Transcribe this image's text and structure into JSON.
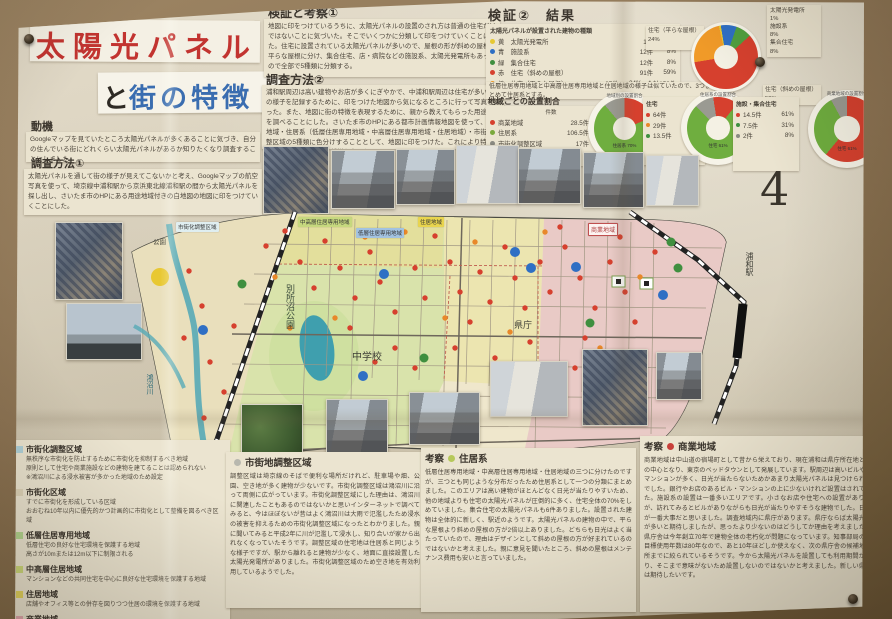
{
  "page_number": "4",
  "title": {
    "main": "太陽光パネル",
    "sub_prefix": "と",
    "sub_main": "街の特徴"
  },
  "intro": {
    "motivation_heading": "動機",
    "motivation_body": "Googleマップを見ていたところ太陽光パネルが多くあることに気づき、自分の住んでいる街にどれくらい太陽光パネルがあるか知りたくなり調査することにしました。",
    "method1_heading": "調査方法①",
    "method1_body": "太陽光パネルを通して街の様子が見えてこないかと考え、Googleマップの航空写真を使って、埼京線中浦和駅から京浜東北線浦和駅の間から太陽光パネルを探し出し、さいたま市のHPにある用途地域付きの白地図の地図に印をつけていくことにした。"
  },
  "upper": {
    "verification1_heading": "検証と考察①",
    "verification1_body": "地図に印をつけているうちに、太陽光パネルの設置のされ方は普通の住宅だけではないことに気づいた。そこでいくつかに分類して印をつけていくことにした。住宅に設置されている太陽光パネルが多いので、屋根の形が斜めの屋根と平らな屋根に分け、集合住宅、店・病院などの施設系、太陽光発電所もあったので全部で5種類に分類する。",
    "method2_heading": "調査方法②",
    "method2_body": "浦和駅周辺は高い建物やお店が多くにぎやかで、中浦和駅周辺は住宅が多い。街の様子を記録するために、印をつけた地図から気になるところに行って写真を撮った。また、地図に街の特徴を表現するために、親から教えてもらった用途地域を調べることにした。さいたま市のHPにある都市計画情報地図を使って、商業地域・住居系（低層住居専用地域・中高層住居専用地域・住居地域）・市街化調整区域の5種類に色分けすることとして、地図に印をつけた。これにより特徴が浮かびあがってくると仮説を立てた。"
  },
  "results": {
    "heading": "検証②　結果",
    "table_title": "太陽光パネルが設置された建物の種類",
    "rows": [
      {
        "color": "#e6c832",
        "label": "黄　太陽光発電所",
        "count": "1件",
        "pct": "1%"
      },
      {
        "color": "#2f6fc4",
        "label": "青　施設系",
        "count": "12件",
        "pct": "8%"
      },
      {
        "color": "#3f8f3f",
        "label": "緑　集合住宅",
        "count": "12件",
        "pct": "8%"
      },
      {
        "color": "#d6402e",
        "label": "赤　住宅（斜めの屋根）",
        "count": "91件",
        "pct": "59%"
      },
      {
        "color": "#f09a28",
        "label": "橙　住宅（平らな屋根）",
        "count": "37件",
        "pct": "24%"
      }
    ],
    "total": "合計153件",
    "note": "低層住居専用地域と中高層住居専用地域と住居地域の様子は似ていたので、3つまとめて住居系とする。"
  },
  "region_share": {
    "heading": "地域ごとの設置割合",
    "col_header": "件数",
    "rows": [
      {
        "color": "#d6402e",
        "label": "商業地域",
        "count": "28.5件",
        "pct": "19%"
      },
      {
        "color": "#7aa93c",
        "label": "住居系",
        "count": "106.5件",
        "pct": "70%"
      },
      {
        "color": "#8a8a82",
        "label": "市街化調整区域",
        "count": "17件",
        "pct": "11%"
      }
    ],
    "footnote": "※都市公園　1件"
  },
  "sub_stats": [
    {
      "header": "住宅",
      "rows": [
        {
          "color": "#d6402e",
          "count": "64件",
          "pct": "61%"
        },
        {
          "color": "#e8882a",
          "count": "29件",
          "pct": "27%"
        },
        {
          "color": "#3f8f3f",
          "count": "13.5件",
          "pct": "12%"
        }
      ]
    },
    {
      "header": "施設・集合住宅",
      "rows": [
        {
          "color": "#d6402e",
          "count": "14.5件",
          "pct": "61%"
        },
        {
          "color": "#3f8f3f",
          "count": "7.5件",
          "pct": "31%"
        },
        {
          "color": "#8a8a82",
          "count": "2件",
          "pct": "8%"
        }
      ]
    }
  ],
  "big_donut": {
    "slices": [
      {
        "color": "#e6c832",
        "pct": 1
      },
      {
        "color": "#2f6fc4",
        "pct": 8
      },
      {
        "color": "#4f9f3f",
        "pct": 8
      },
      {
        "color": "#d6402e",
        "pct": 59
      },
      {
        "color": "#f09a28",
        "pct": 24
      }
    ],
    "legend_right": "太陽光発電所\n1%\n施設系\n8%\n集合住宅\n8%",
    "label_left": "住宅（平らな屋根）\n24%",
    "label_bottom": "住宅（斜めの屋根）\n59%"
  },
  "donut1": {
    "header": "地域別の設置割合",
    "inner_label": "住居系 70%",
    "slices": [
      {
        "color": "#9a9a92",
        "pct": 11
      },
      {
        "color": "#d6402e",
        "pct": 19
      },
      {
        "color": "#6fae3f",
        "pct": 70
      }
    ]
  },
  "donut2": {
    "header": "住居系の設置割合",
    "inner_label": "住宅 61%",
    "slices": [
      {
        "color": "#9a9a92",
        "pct": 10
      },
      {
        "color": "#d6402e",
        "pct": 13
      },
      {
        "color": "#6fae3f",
        "pct": 77
      }
    ]
  },
  "donut3": {
    "header": "商業地域の設置割合",
    "inner_label": "住宅 61%",
    "slices": [
      {
        "color": "#d6402e",
        "pct": 61
      },
      {
        "color": "#6fae3f",
        "pct": 31
      },
      {
        "color": "#9a9a92",
        "pct": 8
      }
    ]
  },
  "map": {
    "tags": [
      {
        "label": "市街化調整区域",
        "bg": "#dfeef0"
      },
      {
        "label": "中高層住居専用地域",
        "bg": "#c6d87e"
      },
      {
        "label": "低層住居専用地域",
        "bg": "#a2c2e0"
      },
      {
        "label": "住居地域",
        "bg": "#e8d44e"
      },
      {
        "label": "商業地域",
        "bg": "#fdf4f2"
      }
    ],
    "places": [
      "別所沼公園",
      "中学校",
      "県庁",
      "浦和駅",
      "鴻沼川",
      "公園"
    ],
    "dots": [
      {
        "name": "住宅（斜めの屋根）",
        "color": "#d6402e",
        "r": 2.7,
        "points": [
          [
            75,
            65
          ],
          [
            88,
            100
          ],
          [
            70,
            132
          ],
          [
            96,
            156
          ],
          [
            110,
            186
          ],
          [
            90,
            212
          ],
          [
            120,
            120
          ],
          [
            152,
            40
          ],
          [
            171,
            25
          ],
          [
            186,
            56
          ],
          [
            200,
            82
          ],
          [
            211,
            35
          ],
          [
            226,
            62
          ],
          [
            241,
            92
          ],
          [
            236,
            122
          ],
          [
            256,
            46
          ],
          [
            266,
            76
          ],
          [
            281,
            106
          ],
          [
            301,
            62
          ],
          [
            311,
            92
          ],
          [
            321,
            30
          ],
          [
            336,
            56
          ],
          [
            346,
            86
          ],
          [
            356,
            116
          ],
          [
            341,
            142
          ],
          [
            366,
            66
          ],
          [
            376,
            96
          ],
          [
            391,
            41
          ],
          [
            401,
            72
          ],
          [
            411,
            102
          ],
          [
            426,
            56
          ],
          [
            436,
            86
          ],
          [
            301,
            162
          ],
          [
            281,
            142
          ],
          [
            261,
            156
          ],
          [
            381,
            152
          ],
          [
            416,
            136
          ],
          [
            451,
            41
          ],
          [
            466,
            72
          ],
          [
            481,
            102
          ],
          [
            471,
            132
          ],
          [
            496,
            56
          ],
          [
            511,
            86
          ],
          [
            521,
            116
          ],
          [
            541,
            46
          ],
          [
            531,
            152
          ],
          [
            461,
            162
          ],
          [
            506,
            31
          ],
          [
            446,
            21
          ],
          [
            426,
            206
          ]
        ]
      },
      {
        "name": "住宅（平らな屋根）",
        "color": "#e8882a",
        "r": 2.7,
        "points": [
          [
            161,
            71
          ],
          [
            221,
            112
          ],
          [
            251,
            31
          ],
          [
            331,
            112
          ],
          [
            361,
            36
          ],
          [
            396,
            126
          ],
          [
            431,
            26
          ],
          [
            486,
            142
          ],
          [
            526,
            71
          ],
          [
            291,
            26
          ],
          [
            176,
            122
          ],
          [
            406,
            162
          ]
        ]
      },
      {
        "name": "集合住宅",
        "color": "#3f8f3f",
        "r": 4.5,
        "points": [
          [
            128,
            78
          ],
          [
            310,
            152
          ],
          [
            476,
            117
          ],
          [
            557,
            36
          ],
          [
            564,
            62
          ]
        ]
      },
      {
        "name": "施設系",
        "color": "#2f6fc4",
        "r": 5,
        "points": [
          [
            270,
            68
          ],
          [
            89,
            124
          ],
          [
            401,
            46
          ],
          [
            417,
            62
          ],
          [
            462,
            61
          ],
          [
            549,
            89
          ],
          [
            249,
            170
          ]
        ]
      },
      {
        "name": "太陽光発電所",
        "color": "#e8c832",
        "r": 9,
        "points": [
          [
            46,
            71
          ]
        ]
      }
    ]
  },
  "legend": {
    "items": [
      {
        "chip": "#aed0d8",
        "heading": "市街化調整区域",
        "body": "無秩序な市街化を防止するために市街化を抑制するべき地域\n原則として住宅や商業施設などの建物を建てることは認められない\n※鴻沼川による浸水被害が多かった地域のため設定"
      },
      {
        "chip": "#ddd3b8",
        "heading": "市街化区域",
        "body": "すでに市街化を形成している区域\nおおむね10年以内に優先的かつ計画的に市街化として整備を図るべき区域"
      },
      {
        "chip": "#b2d48e",
        "heading": "低層住居専用地域",
        "body": "低層住宅の良好な住宅環境を保護する地域\n高さが10mまたは12m以下に制限される"
      },
      {
        "chip": "#ccd87a",
        "heading": "中高層住居地域",
        "body": "マンションなどの共同住宅を中心に良好な住宅環境を保護する地域"
      },
      {
        "chip": "#e4d45e",
        "heading": "住居地域",
        "body": "店舗やオフィス等との併存を図りつつ住居の環境を保護する地域"
      },
      {
        "chip": "#e0a8ae",
        "heading": "商業地域",
        "body": "店やその他の業務の利便性を高めるために指定された地域\n人を集め店舗を誘導するために高い建物を建てることが多い"
      }
    ]
  },
  "discussions": [
    {
      "prefix": "",
      "bullet": "#b8b8ae",
      "heading": "市街地調整区域",
      "body": "調整区域は埼京線のそばで便利な場所だけれど、駐車場や畑、公園、空き地が多く建物が少ないです。市街化調整区域は鴻沼川に沿って両側に広がっています。市街化調整区域にした理由は、鴻沼川に関連したこともあるのではないかと思いインターネットで調べてみると、今はほぼないが昔はよく鴻沼川は大雨で氾濫したため浸水の被害を抑えるための市街化調整区域になったとわかりました。親に聞いてみると平成2年に川が氾濫して浸水し、知り合いが家から出れなくなっていたそうです。調整区域の住宅地は住居系と同じような様子ですが、駅から離れると建物が少なく、地面に直接設置した太陽光発電所がありました。市街化調整区域のため空き地を有効利用しているようでした。"
    },
    {
      "prefix": "考察",
      "bullet": "#b6c85a",
      "heading": "住居系",
      "body": "低層住居専用地域・中高層住居専用地域・住居地域の三つに分けたのですが、三つとも同じような分布だったため住居系として一つの分類にまとめました。このエリアは高い建物がほとんどなく日光が当たりやすいため、他の地域よりも住宅の太陽光パネルが圧倒的に多く、住宅全体の70%をしめていました。集合住宅の太陽光パネルも6件ありました。設置された建物は全体的に新しく、駅近のようです。太陽光パネルの建物の中で、平らな屋根より斜めの屋根の方が2倍以上ありました。どちらも日光はよく当たっていたので、理由はデザインとして斜めの屋根の方が好まれているのではないかと考えました。親に意見を聞いたところ、斜めの屋根はメンテナンス費用も安いと言っていました。"
    },
    {
      "prefix": "考察",
      "bullet": "#c8403a",
      "heading": "商業地域",
      "body": "商業地域は中山道の宿場町として昔から栄えており、現在浦和は県庁所在地として県の中心となり、東京のベッドタウンとして発展しています。駅周辺は高いビルやタワーマンションが多く、日光が当たらないためかあまり太陽光パネルは見つけられませんでした。銀行やお店のあるビル・マンションの上に少ないけれど設置はされていました。施設系の設置は一番多いエリアです。小さなお店や住宅への設置がありましたが、訪れてみるとビルがありながらも日光が当たりやすそうな建物でした。日当たりが一番大事だと思いました。調査地域内に県庁があります。県庁ならば太陽光パネルが多いと期待しましたが、思ったより少ないのはどうしてか理由を考えました。埼玉県庁舎は今年創立70年で建物全体の老朽化が問題になっています。知事部局の建物の目標使用年数は80年なので、あと10年ほどしか使えなく、次の県庁舎の候補地も二ヶ所までに絞られているそうです。今から太陽光パネルを設置しても利用期間が短くなり、そこまで意味がないため設置しないのではないかと考えました。新しい県庁舎には期待したいです。"
    }
  ],
  "chart_data": [
    {
      "type": "pie",
      "title": "太陽光パネルが設置された建物の種類",
      "labels": [
        "太陽光発電所",
        "施設系",
        "集合住宅",
        "住宅（斜めの屋根）",
        "住宅（平らな屋根）"
      ],
      "counts": [
        1,
        12,
        12,
        91,
        37
      ],
      "values": [
        1,
        8,
        8,
        59,
        24
      ],
      "total": 153,
      "colors": [
        "#e6c832",
        "#2f6fc4",
        "#3f8f3f",
        "#d6402e",
        "#f09a28"
      ],
      "legend_position": "around"
    },
    {
      "type": "pie",
      "title": "地域ごとの設置割合",
      "labels": [
        "商業地域",
        "住居系",
        "市街化調整区域"
      ],
      "counts": [
        28.5,
        106.5,
        17
      ],
      "values": [
        19,
        70,
        11
      ],
      "note": "※都市公園 1件"
    },
    {
      "type": "pie",
      "title": "住居系の設置割合",
      "labels": [
        "住宅（斜め）",
        "住宅（平ら）",
        "その他"
      ],
      "counts": [
        64,
        29,
        13.5
      ],
      "values": [
        61,
        27,
        12
      ]
    },
    {
      "type": "pie",
      "title": "商業地域の設置割合",
      "labels": [
        "住宅",
        "施設・集合住宅",
        "その他"
      ],
      "counts": [
        14.5,
        7.5,
        2
      ],
      "values": [
        61,
        31,
        8
      ]
    }
  ]
}
